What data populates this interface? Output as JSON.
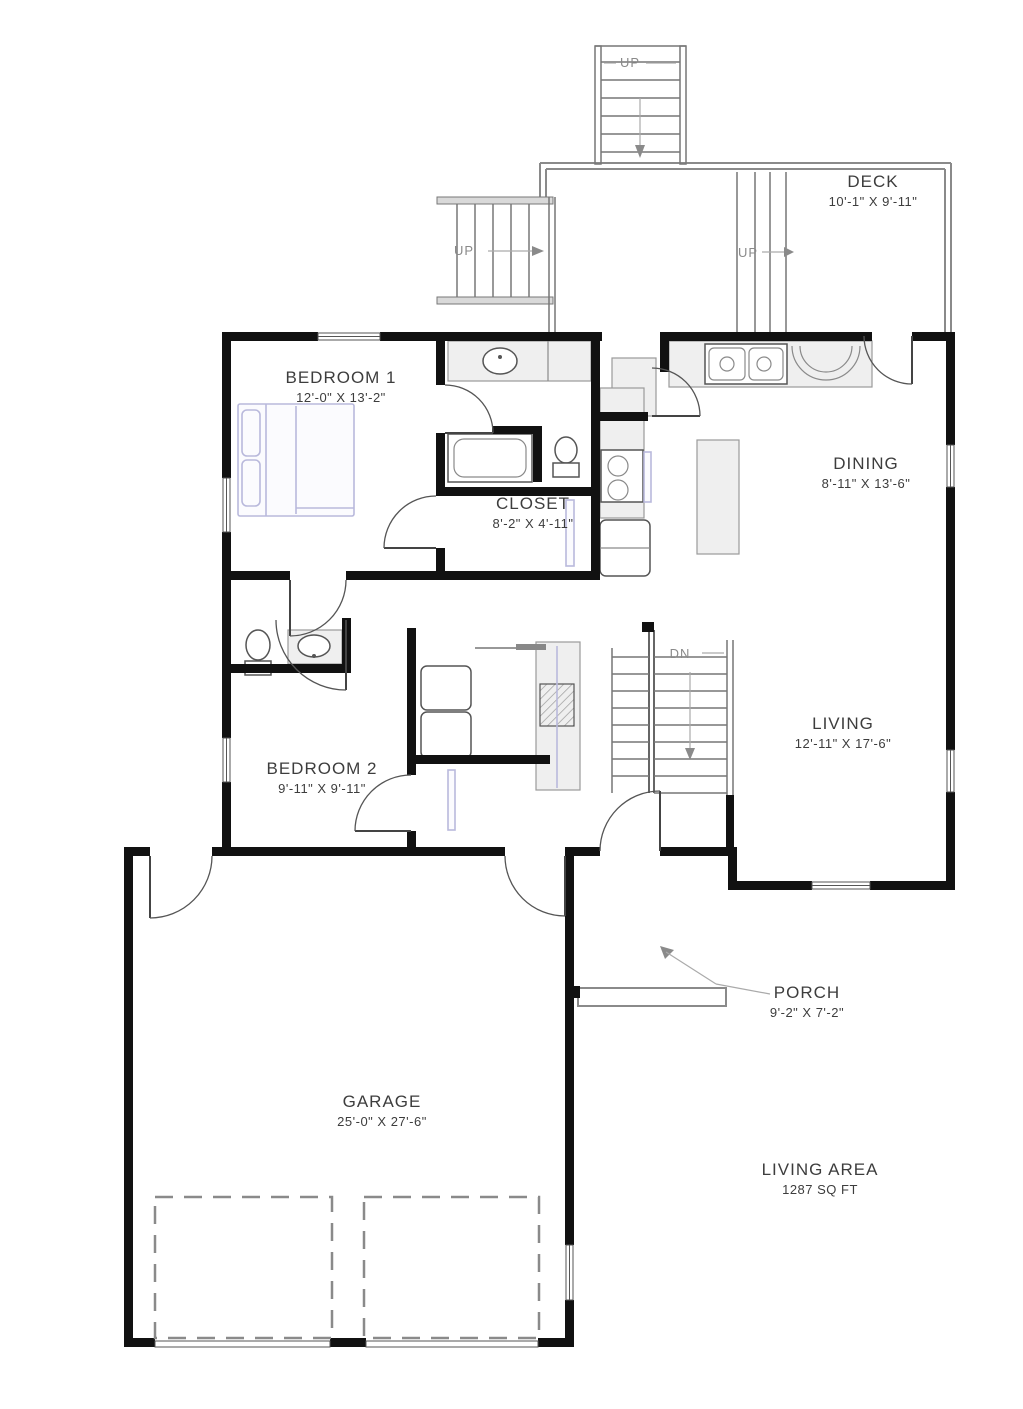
{
  "colors": {
    "wall": "#111111",
    "line": "#777777",
    "rail": "#8a8a8a",
    "fixture_fill": "#efefef",
    "furniture": "#b9b9dc",
    "text": "#3d3d3d",
    "stair_text": "#8a8a8a"
  },
  "rooms": [
    {
      "id": "deck",
      "name": "DECK",
      "dims": "10'-1\" X 9'-11\""
    },
    {
      "id": "bedroom1",
      "name": "BEDROOM 1",
      "dims": "12'-0\" X 13'-2\""
    },
    {
      "id": "closet",
      "name": "CLOSET",
      "dims": "8'-2\" X 4'-11\""
    },
    {
      "id": "dining",
      "name": "DINING",
      "dims": "8'-11\" X 13'-6\""
    },
    {
      "id": "living",
      "name": "LIVING",
      "dims": "12'-11\" X 17'-6\""
    },
    {
      "id": "bedroom2",
      "name": "BEDROOM 2",
      "dims": "9'-11\" X 9'-11\""
    },
    {
      "id": "garage",
      "name": "GARAGE",
      "dims": "25'-0\" X 27'-6\""
    },
    {
      "id": "porch",
      "name": "PORCH",
      "dims": "9'-2\" X 7'-2\""
    },
    {
      "id": "living_area",
      "name": "LIVING AREA",
      "dims": "1287 SQ FT"
    }
  ],
  "stair_labels": [
    {
      "id": "stair-top",
      "text": "UP"
    },
    {
      "id": "stair-left",
      "text": "UP"
    },
    {
      "id": "stair-deck",
      "text": "UP"
    },
    {
      "id": "stair-interior",
      "text": "DN"
    }
  ]
}
